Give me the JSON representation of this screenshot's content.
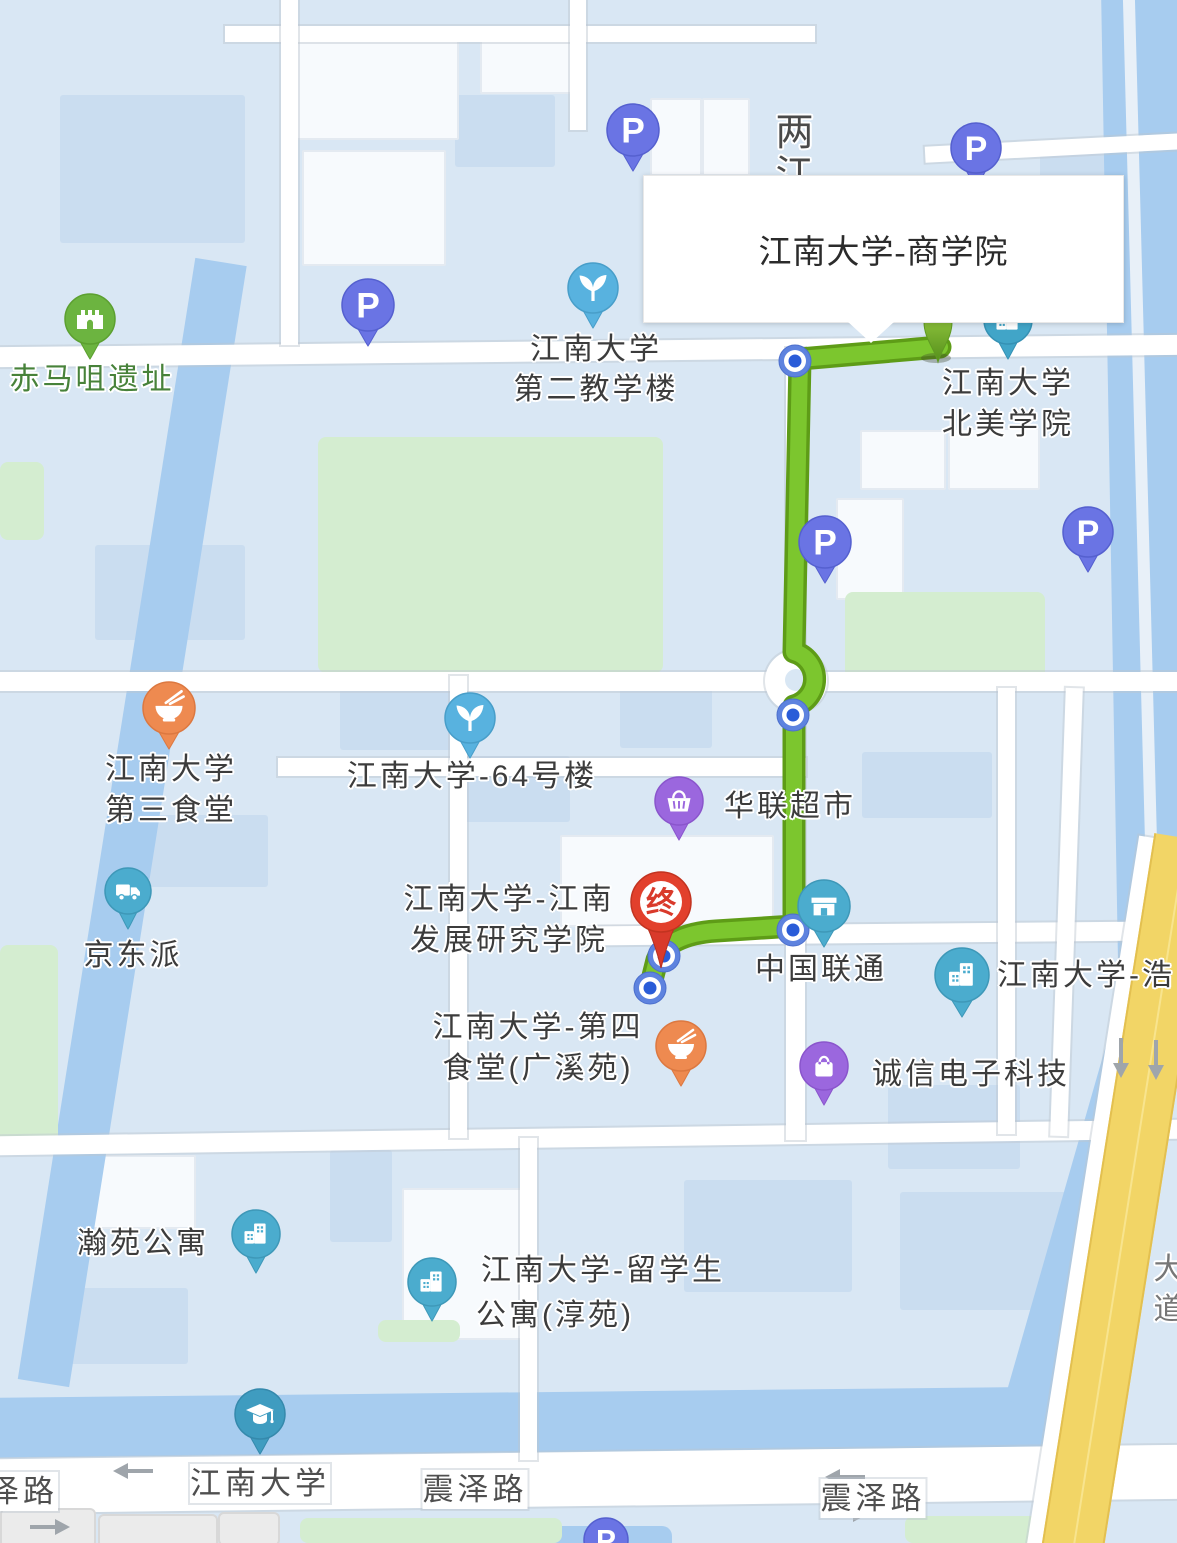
{
  "popup": {
    "title": "江南大学-商学院"
  },
  "colors": {
    "route_green": "#7CC62E",
    "route_casing": "#5E9C17",
    "waypoint_outer": "#5E83DF",
    "waypoint_dot": "#2A5CD8",
    "end_red": "#E2402C",
    "start_green_light": "#9ACD44",
    "start_green_dark": "#55901B",
    "highway_yellow": "#F2D566",
    "water_blue": "#A7CCEF",
    "park_green": "#D4EDD0",
    "parking_purple": "#6A74E4",
    "poi_teal": "#4BACCE",
    "poi_orange": "#EE8A50",
    "poi_violet": "#9B67DE",
    "arrow_gray": "#9FA5AB"
  },
  "route": {
    "path": "M 940 347 L 800 359 L 794 652 A 28 28 0 0 1 794 706 L 794 926 L 716 931 C 684 933 663 944 657 960 L 650 988",
    "end_label": "终"
  },
  "waypoints": [
    {
      "x": 795,
      "y": 361
    },
    {
      "x": 793,
      "y": 715
    },
    {
      "x": 793,
      "y": 930
    },
    {
      "x": 664,
      "y": 956
    },
    {
      "x": 650,
      "y": 988
    }
  ],
  "pins": [
    {
      "name": "parking-pin-1",
      "icon": "p",
      "x": 633,
      "y": 130,
      "r": 26,
      "color": "#6A74E4",
      "stroke": "#5560CF"
    },
    {
      "name": "parking-pin-2",
      "icon": "p",
      "x": 976,
      "y": 148,
      "r": 25,
      "color": "#6A74E4",
      "stroke": "#5560CF"
    },
    {
      "name": "heritage-ruins-pin",
      "icon": "ruins",
      "x": 90,
      "y": 319,
      "r": 25,
      "color": "#6CB440",
      "stroke": "#5CA030"
    },
    {
      "name": "parking-pin-3",
      "icon": "p",
      "x": 368,
      "y": 305,
      "r": 26,
      "color": "#6A74E4",
      "stroke": "#5560CF"
    },
    {
      "name": "scenic-sprout-pin-1",
      "icon": "sprout",
      "x": 593,
      "y": 288,
      "r": 25,
      "color": "#58B2DF",
      "stroke": "#489EC9"
    },
    {
      "name": "college-pin-behind-popup",
      "icon": "building",
      "x": 1008,
      "y": 320,
      "r": 24,
      "color": "#41A5C8",
      "stroke": "#3591B4"
    },
    {
      "name": "route-start-pin",
      "icon": "start",
      "x": 938,
      "y": 322,
      "r": 15,
      "color": "#76B62C",
      "stroke": "#5F9A22"
    },
    {
      "name": "parking-pin-4",
      "icon": "p",
      "x": 825,
      "y": 542,
      "r": 26,
      "color": "#6A74E4",
      "stroke": "#5560CF"
    },
    {
      "name": "parking-pin-5",
      "icon": "p",
      "x": 1088,
      "y": 532,
      "r": 25,
      "color": "#6A74E4",
      "stroke": "#5560CF"
    },
    {
      "name": "canteen3-pin",
      "icon": "bowl",
      "x": 169,
      "y": 708,
      "r": 26,
      "color": "#EE8A50",
      "stroke": "#DC7840"
    },
    {
      "name": "scenic-sprout-pin-2",
      "icon": "sprout",
      "x": 470,
      "y": 718,
      "r": 25,
      "color": "#58B2DF",
      "stroke": "#489EC9"
    },
    {
      "name": "supermarket-pin",
      "icon": "basket",
      "x": 679,
      "y": 801,
      "r": 24,
      "color": "#9B67DE",
      "stroke": "#8A55CC"
    },
    {
      "name": "jd-delivery-pin",
      "icon": "truck",
      "x": 128,
      "y": 891,
      "r": 23,
      "color": "#4BACCE",
      "stroke": "#3E98B8"
    },
    {
      "name": "unicom-store-pin",
      "icon": "store",
      "x": 824,
      "y": 906,
      "r": 26,
      "color": "#4BACCE",
      "stroke": "#3E98B8"
    },
    {
      "name": "hao-building-pin",
      "icon": "building",
      "x": 962,
      "y": 975,
      "r": 27,
      "color": "#4BACCE",
      "stroke": "#3E98B8"
    },
    {
      "name": "canteen4-pin",
      "icon": "bowl",
      "x": 681,
      "y": 1046,
      "r": 25,
      "color": "#EE8A50",
      "stroke": "#DC7840"
    },
    {
      "name": "electronics-shop-pin",
      "icon": "bag",
      "x": 824,
      "y": 1066,
      "r": 24,
      "color": "#9B67DE",
      "stroke": "#8A55CC"
    },
    {
      "name": "hanyuan-apartment-pin",
      "icon": "building",
      "x": 256,
      "y": 1234,
      "r": 24,
      "color": "#4BACCE",
      "stroke": "#3E98B8"
    },
    {
      "name": "chunyuan-apartment-pin",
      "icon": "building",
      "x": 432,
      "y": 1282,
      "r": 24,
      "color": "#4BACCE",
      "stroke": "#3E98B8"
    },
    {
      "name": "university-gradcap-pin",
      "icon": "gradcap",
      "x": 260,
      "y": 1414,
      "r": 25,
      "color": "#3F9CC0",
      "stroke": "#3589AC"
    },
    {
      "name": "parking-pin-6",
      "icon": "p",
      "x": 606,
      "y": 1540,
      "r": 22,
      "color": "#6A74E4",
      "stroke": "#5560CF"
    },
    {
      "name": "route-end-pin",
      "icon": "end",
      "x": 661,
      "y": 902,
      "r": 30,
      "color": "#E2402C",
      "stroke": "#C23320",
      "text": "终"
    }
  ],
  "labels": [
    {
      "name": "label-liangjiang",
      "lines": [
        "两",
        "江"
      ],
      "x": 796,
      "y": 112,
      "size": 38,
      "lh": 42,
      "color": "#4A4A4A"
    },
    {
      "name": "label-chimaju-ruins",
      "lines": [
        "赤马咀遗址"
      ],
      "x": 92,
      "y": 361,
      "size": 30,
      "color": "#47823A"
    },
    {
      "name": "label-no2-teaching-building",
      "lines": [
        "江南大学",
        "第二教学楼"
      ],
      "x": 596,
      "y": 330,
      "size": 30,
      "lh": 40
    },
    {
      "name": "label-north-america-college",
      "lines": [
        "江南大学",
        "北美学院"
      ],
      "x": 1008,
      "y": 363,
      "size": 30,
      "lh": 41
    },
    {
      "name": "label-canteen3",
      "lines": [
        "江南大学",
        "第三食堂"
      ],
      "x": 171,
      "y": 749,
      "size": 30,
      "lh": 41
    },
    {
      "name": "label-building64",
      "lines": [
        "江南大学-64号楼"
      ],
      "x": 472,
      "y": 758,
      "size": 30
    },
    {
      "name": "label-hualian-supermarket",
      "lines": [
        "华联超市"
      ],
      "x": 790,
      "y": 788,
      "size": 30
    },
    {
      "name": "label-jingdongpai",
      "lines": [
        "京东派"
      ],
      "x": 133,
      "y": 937,
      "size": 30
    },
    {
      "name": "label-development-institute",
      "lines": [
        "江南大学-江南",
        "发展研究学院"
      ],
      "x": 509,
      "y": 879,
      "size": 30,
      "lh": 41
    },
    {
      "name": "label-china-unicom",
      "lines": [
        "中国联通"
      ],
      "x": 821,
      "y": 951,
      "size": 30
    },
    {
      "name": "label-hao-building",
      "lines": [
        "江南大学-浩"
      ],
      "x": 997,
      "y": 957,
      "size": 30,
      "anchor": "left"
    },
    {
      "name": "label-canteen4",
      "lines": [
        "江南大学-第四",
        "食堂(广溪苑)"
      ],
      "x": 538,
      "y": 1007,
      "size": 30,
      "lh": 41
    },
    {
      "name": "label-chengxin-electronics",
      "lines": [
        "诚信电子科技"
      ],
      "x": 971,
      "y": 1056,
      "size": 30
    },
    {
      "name": "label-hanyuan-apartment",
      "lines": [
        "瀚苑公寓"
      ],
      "x": 143,
      "y": 1225,
      "size": 30
    },
    {
      "name": "label-intl-student-apartment-1",
      "lines": [
        "江南大学-留学生"
      ],
      "x": 603,
      "y": 1252,
      "size": 30
    },
    {
      "name": "label-intl-student-apartment-2",
      "lines": [
        "公寓(淳苑)"
      ],
      "x": 555,
      "y": 1297,
      "size": 30
    },
    {
      "name": "label-jiangnan-university-road",
      "lines": [
        "江南大学"
      ],
      "x": 260,
      "y": 1464,
      "size": 31,
      "road": true
    },
    {
      "name": "label-zelu",
      "lines": [
        "泽路"
      ],
      "x": -12,
      "y": 1472,
      "size": 31,
      "road": true,
      "anchor": "left"
    },
    {
      "name": "label-zhenzelu-center",
      "lines": [
        "震泽路"
      ],
      "x": 475,
      "y": 1470,
      "size": 31,
      "road": true
    },
    {
      "name": "label-zhenzelu-right",
      "lines": [
        "震泽路"
      ],
      "x": 873,
      "y": 1479,
      "size": 31,
      "road": true
    },
    {
      "name": "label-highway-partial",
      "lines": [
        "大",
        "道"
      ],
      "x": 1170,
      "y": 1250,
      "size": 30,
      "lh": 40,
      "color": "#777777"
    }
  ],
  "arrows": [
    {
      "name": "road-arrow-left-1",
      "x": 133,
      "y": 1471,
      "dir": "left"
    },
    {
      "name": "road-arrow-right-1",
      "x": 50,
      "y": 1527,
      "dir": "right"
    },
    {
      "name": "road-arrow-left-2",
      "x": 845,
      "y": 1477,
      "dir": "left"
    },
    {
      "name": "road-arrow-right-2",
      "x": 848,
      "y": 1514,
      "dir": "right"
    },
    {
      "name": "road-arrow-down-1",
      "x": 1121,
      "y": 1058,
      "dir": "down"
    },
    {
      "name": "road-arrow-down-2",
      "x": 1156,
      "y": 1060,
      "dir": "down"
    }
  ]
}
